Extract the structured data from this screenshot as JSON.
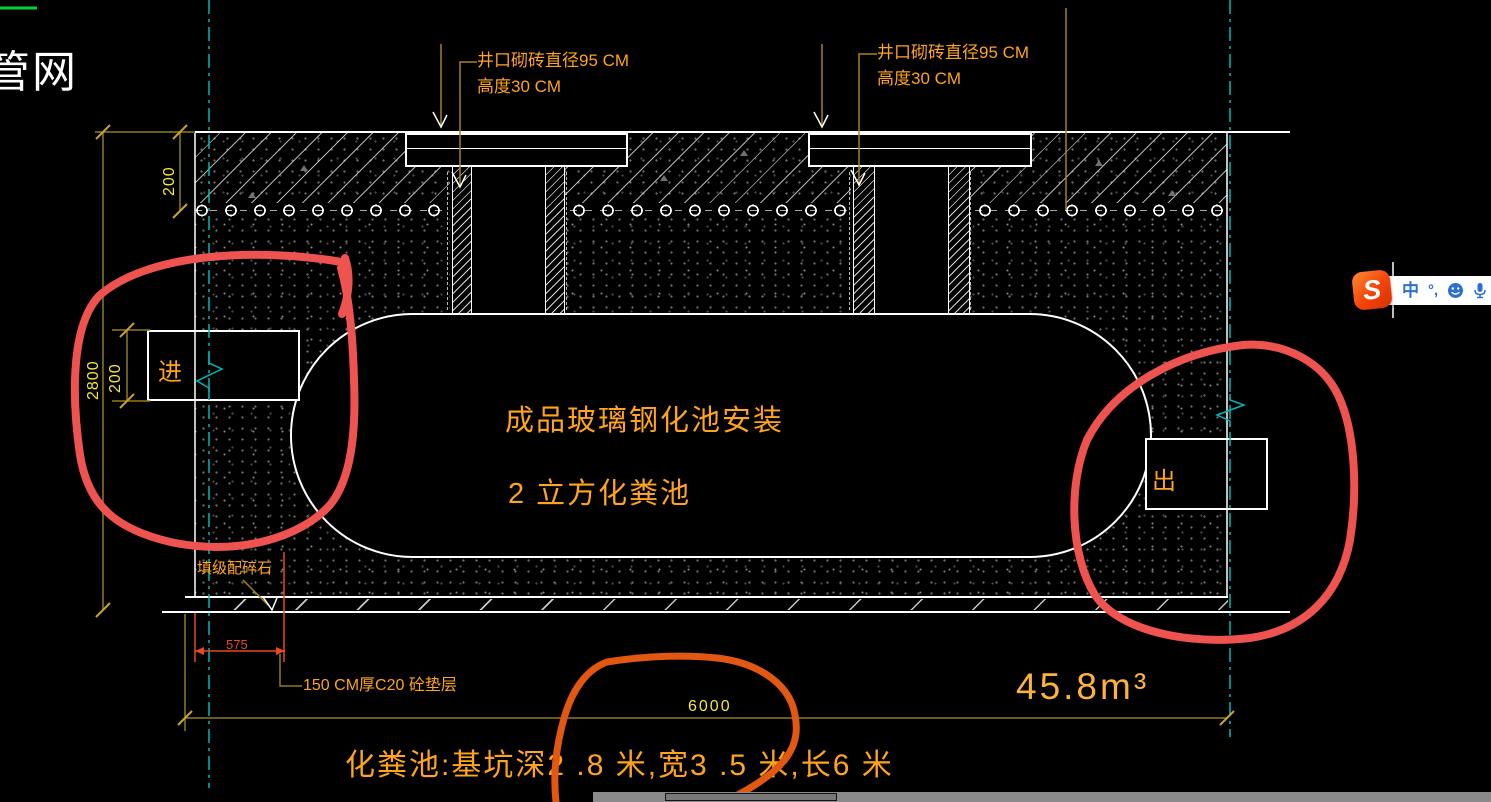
{
  "page": {
    "corner_label": "管网"
  },
  "annotations": {
    "well_left": {
      "line1": "井口砌砖直径95 CM",
      "line2": "高度30 CM"
    },
    "well_right": {
      "line1": "井口砌砖直径95 CM",
      "line2": "高度30 CM"
    },
    "tank_line1": "成品玻璃钢化池安装",
    "tank_line2": "2 立方化粪池",
    "inlet": "进",
    "outlet": "出",
    "gravel": "填级配碎石",
    "bedding": "150 CM厚C20 砼垫层",
    "bottom_note": "化粪池:基坑深2 .8 米,宽3 .5 米,长6 米"
  },
  "dimensions": {
    "band_thickness": "200",
    "pit_depth": "2800",
    "inlet_height": "200",
    "bedding_offset": "575",
    "tank_length": "6000",
    "volume": "45.8m³"
  },
  "ime_toolbar": {
    "logo_letter": "S",
    "mode_label": "中",
    "punctuation_label": "°,",
    "icons": [
      "sogou-logo",
      "chinese-mode",
      "punctuation",
      "emoji",
      "microphone"
    ]
  },
  "colors": {
    "centerline": "#00b7b7",
    "dimension_line": "#8f7a1e",
    "leader_line": "#a8831a",
    "label_orange": "#ffa41c",
    "label_yellow": "#f5e642",
    "dim_red": "#e8491d",
    "volume_orange": "#ffb13d",
    "freehand_red": "#ef5350",
    "freehand_orange": "#e25812",
    "green_line": "#00d435"
  }
}
